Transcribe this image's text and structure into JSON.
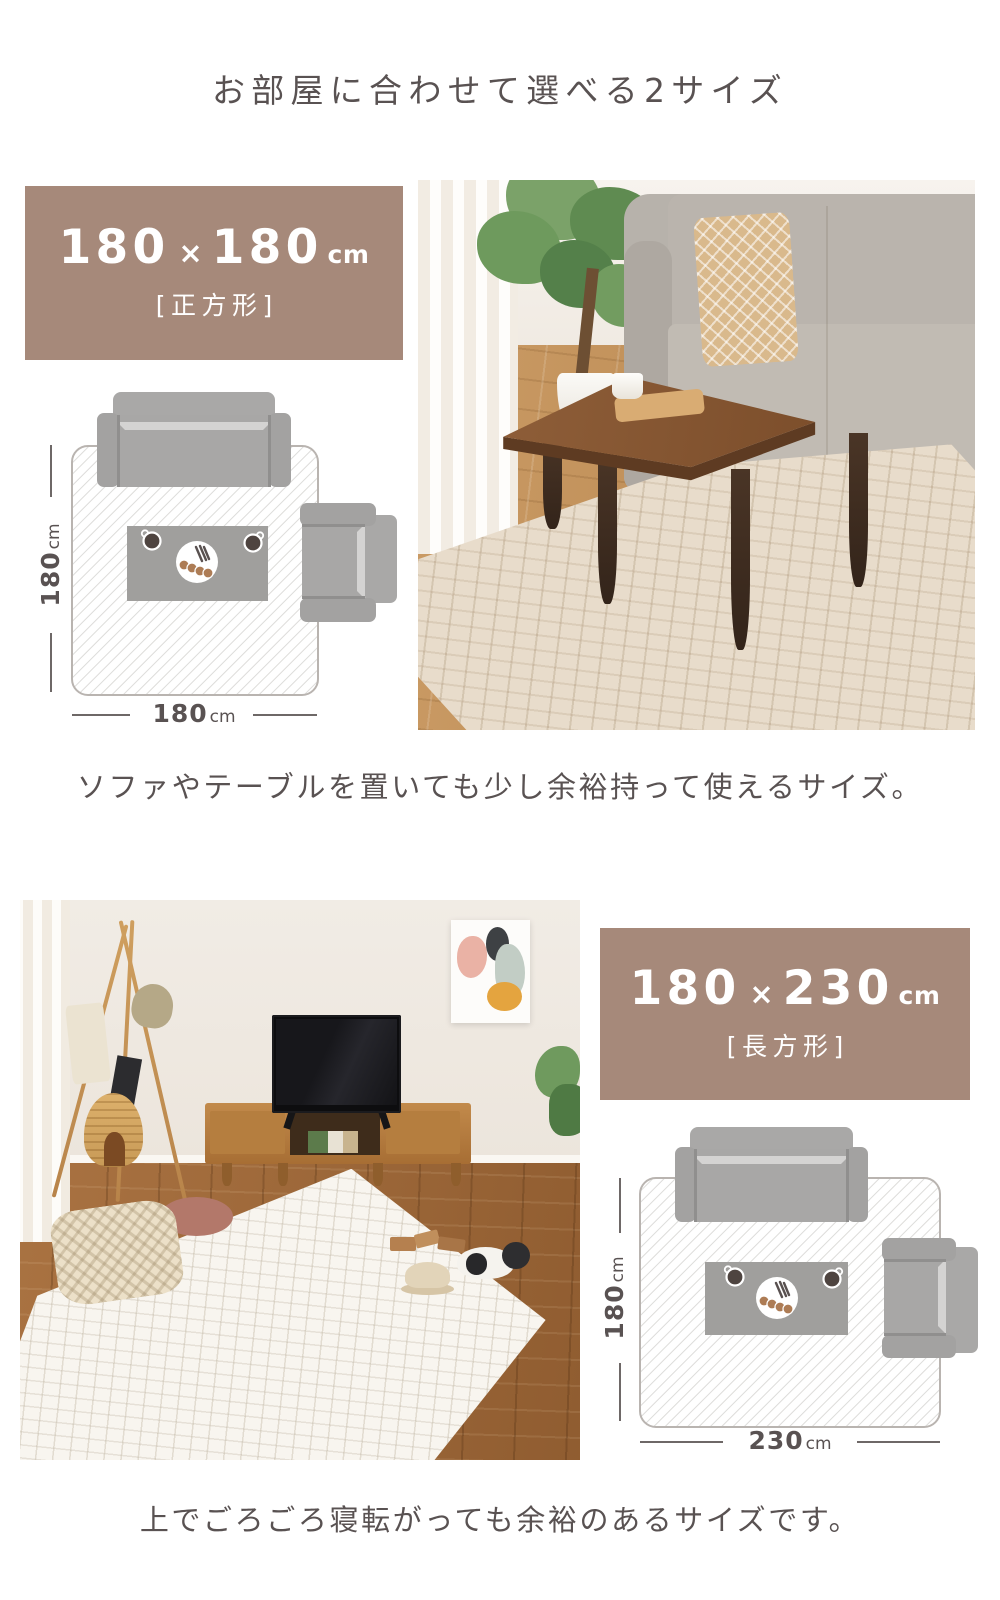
{
  "page": {
    "title": "お部屋に合わせて選べる2サイズ",
    "text_color": "#595252",
    "accent_color": "#a6897a",
    "background_color": "#ffffff"
  },
  "sections": {
    "square": {
      "badge": {
        "num1": "180",
        "times": "×",
        "num2": "180",
        "unit": "cm",
        "shape": "[正方形]"
      },
      "diagram": {
        "side_value": "180",
        "side_unit": "cm",
        "bottom_value": "180",
        "bottom_unit": "cm"
      },
      "caption": "ソファやテーブルを置いても少し余裕持って使えるサイズ。"
    },
    "rect": {
      "badge": {
        "num1": "180",
        "times": "×",
        "num2": "230",
        "unit": "cm",
        "shape": "[長方形]"
      },
      "diagram": {
        "side_value": "180",
        "side_unit": "cm",
        "bottom_value": "230",
        "bottom_unit": "cm"
      },
      "caption": "上でごろごろ寝転がっても余裕のあるサイズです。"
    }
  }
}
